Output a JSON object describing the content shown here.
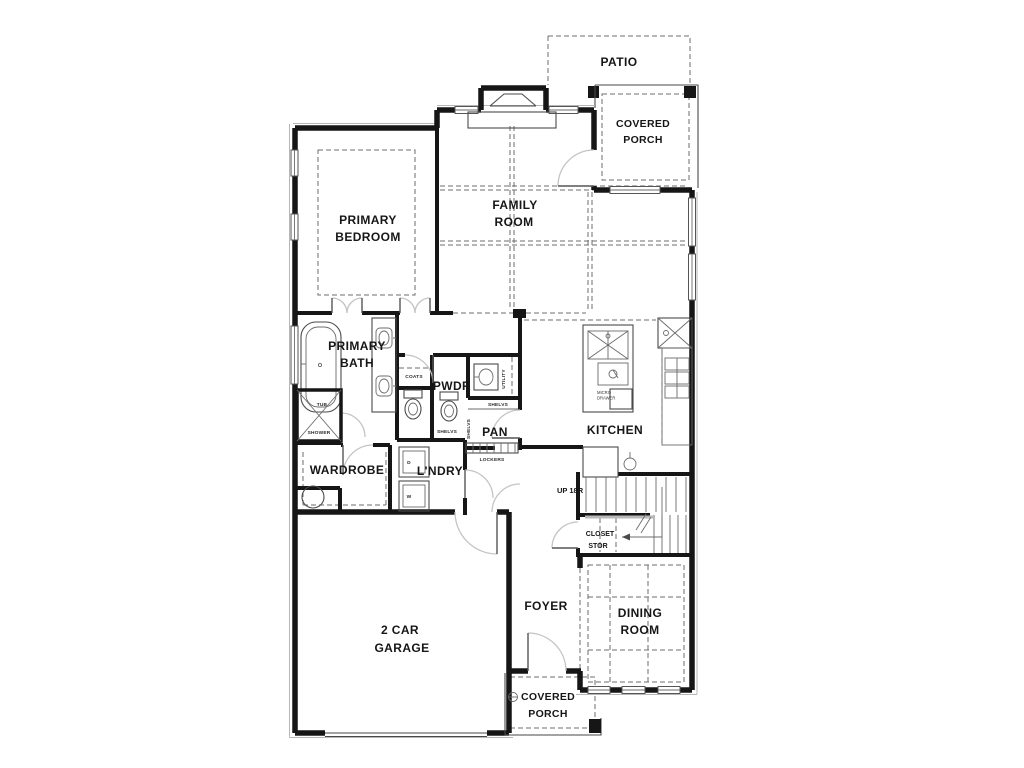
{
  "drawing": {
    "type": "residential-floor-plan",
    "colors": {
      "walls": "#161616",
      "background": "#ffffff",
      "dashed_lines": "#6e6e6e",
      "door_arcs": "#c4c4c4"
    }
  },
  "rooms": {
    "patio": {
      "label": "PATIO"
    },
    "covered_porch_top": {
      "line1": "COVERED",
      "line2": "PORCH"
    },
    "family_room": {
      "line1": "FAMILY",
      "line2": "ROOM"
    },
    "primary_bedroom": {
      "line1": "PRIMARY",
      "line2": "BEDROOM"
    },
    "primary_bath": {
      "line1": "PRIMARY",
      "line2": "BATH"
    },
    "kitchen": {
      "label": "KITCHEN"
    },
    "pantry": {
      "label": "PAN"
    },
    "powder": {
      "label": "PWDR"
    },
    "laundry": {
      "label": "L'NDRY"
    },
    "wardrobe": {
      "label": "WARDROBE"
    },
    "foyer": {
      "label": "FOYER"
    },
    "dining_room": {
      "line1": "DINING",
      "line2": "ROOM"
    },
    "garage": {
      "line1": "2 CAR",
      "line2": "GARAGE"
    },
    "covered_porch_bottom": {
      "line1": "COVERED",
      "line2": "PORCH"
    },
    "closet_under_stairs": {
      "line1": "CLOSET",
      "line2": "STOR"
    }
  },
  "fixtures": {
    "tub": "TUB",
    "shower": "SHOWER",
    "coats": "COATS",
    "shelves_linen": "SHELVS",
    "shelves_pantry_top": "SHELVS",
    "shelves_pantry_side": "SHELVS",
    "utility": "UTILITY",
    "lockers": "LOCKERS",
    "dryer": "D",
    "washer": "W",
    "micro_line1": "MICRO",
    "micro_line2": "DRAWER",
    "stairs_up": "UP 18R"
  }
}
